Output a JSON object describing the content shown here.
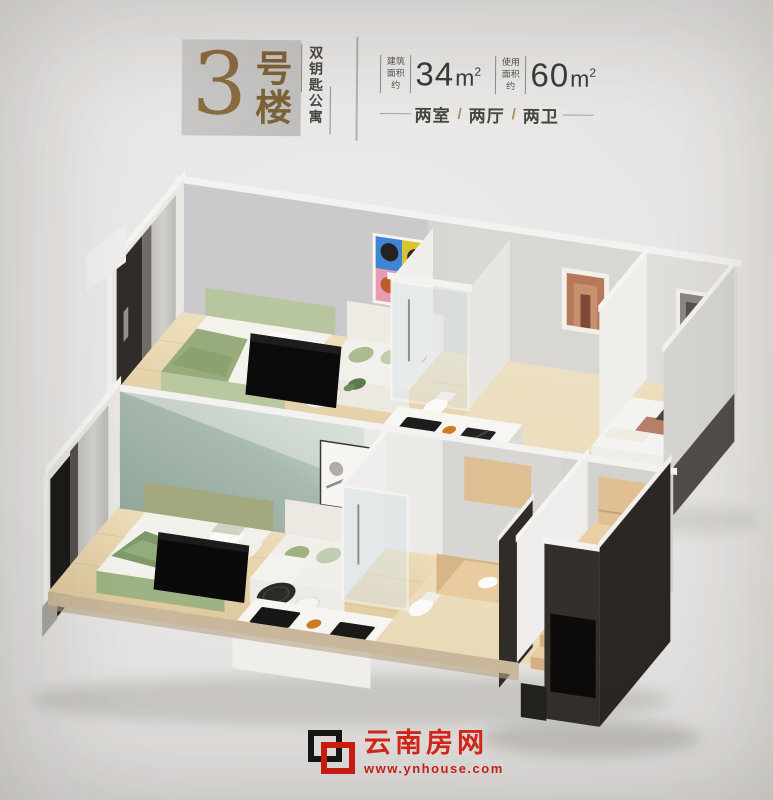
{
  "header": {
    "building_number": "3",
    "building_suffix": "号楼",
    "tagline_vertical": "双钥匙公寓",
    "area_specs": [
      {
        "label_top": "建筑",
        "label_bottom": "面积约",
        "value": "34",
        "unit": "m",
        "power": "2"
      },
      {
        "label_top": "使用",
        "label_bottom": "面积约",
        "value": "60",
        "unit": "m",
        "power": "2"
      }
    ],
    "layout_parts": [
      "两室",
      "两厅",
      "两卫"
    ],
    "layout_separator": "/"
  },
  "footer": {
    "brand_name": "云南房网",
    "brand_url": "www.ynhouse.com"
  },
  "colors": {
    "accent_bronze": "#8a6c41",
    "brand_red": "#d7271b",
    "header_box_gray": "#c8c6c4",
    "background_gray": "#e7e5e3",
    "wood_floor": "#e6d3ac",
    "teal_accent_wall": "#9fb2a8",
    "charcoal_wall": "#2e2b27",
    "sofa_green": "#a9bc90"
  }
}
